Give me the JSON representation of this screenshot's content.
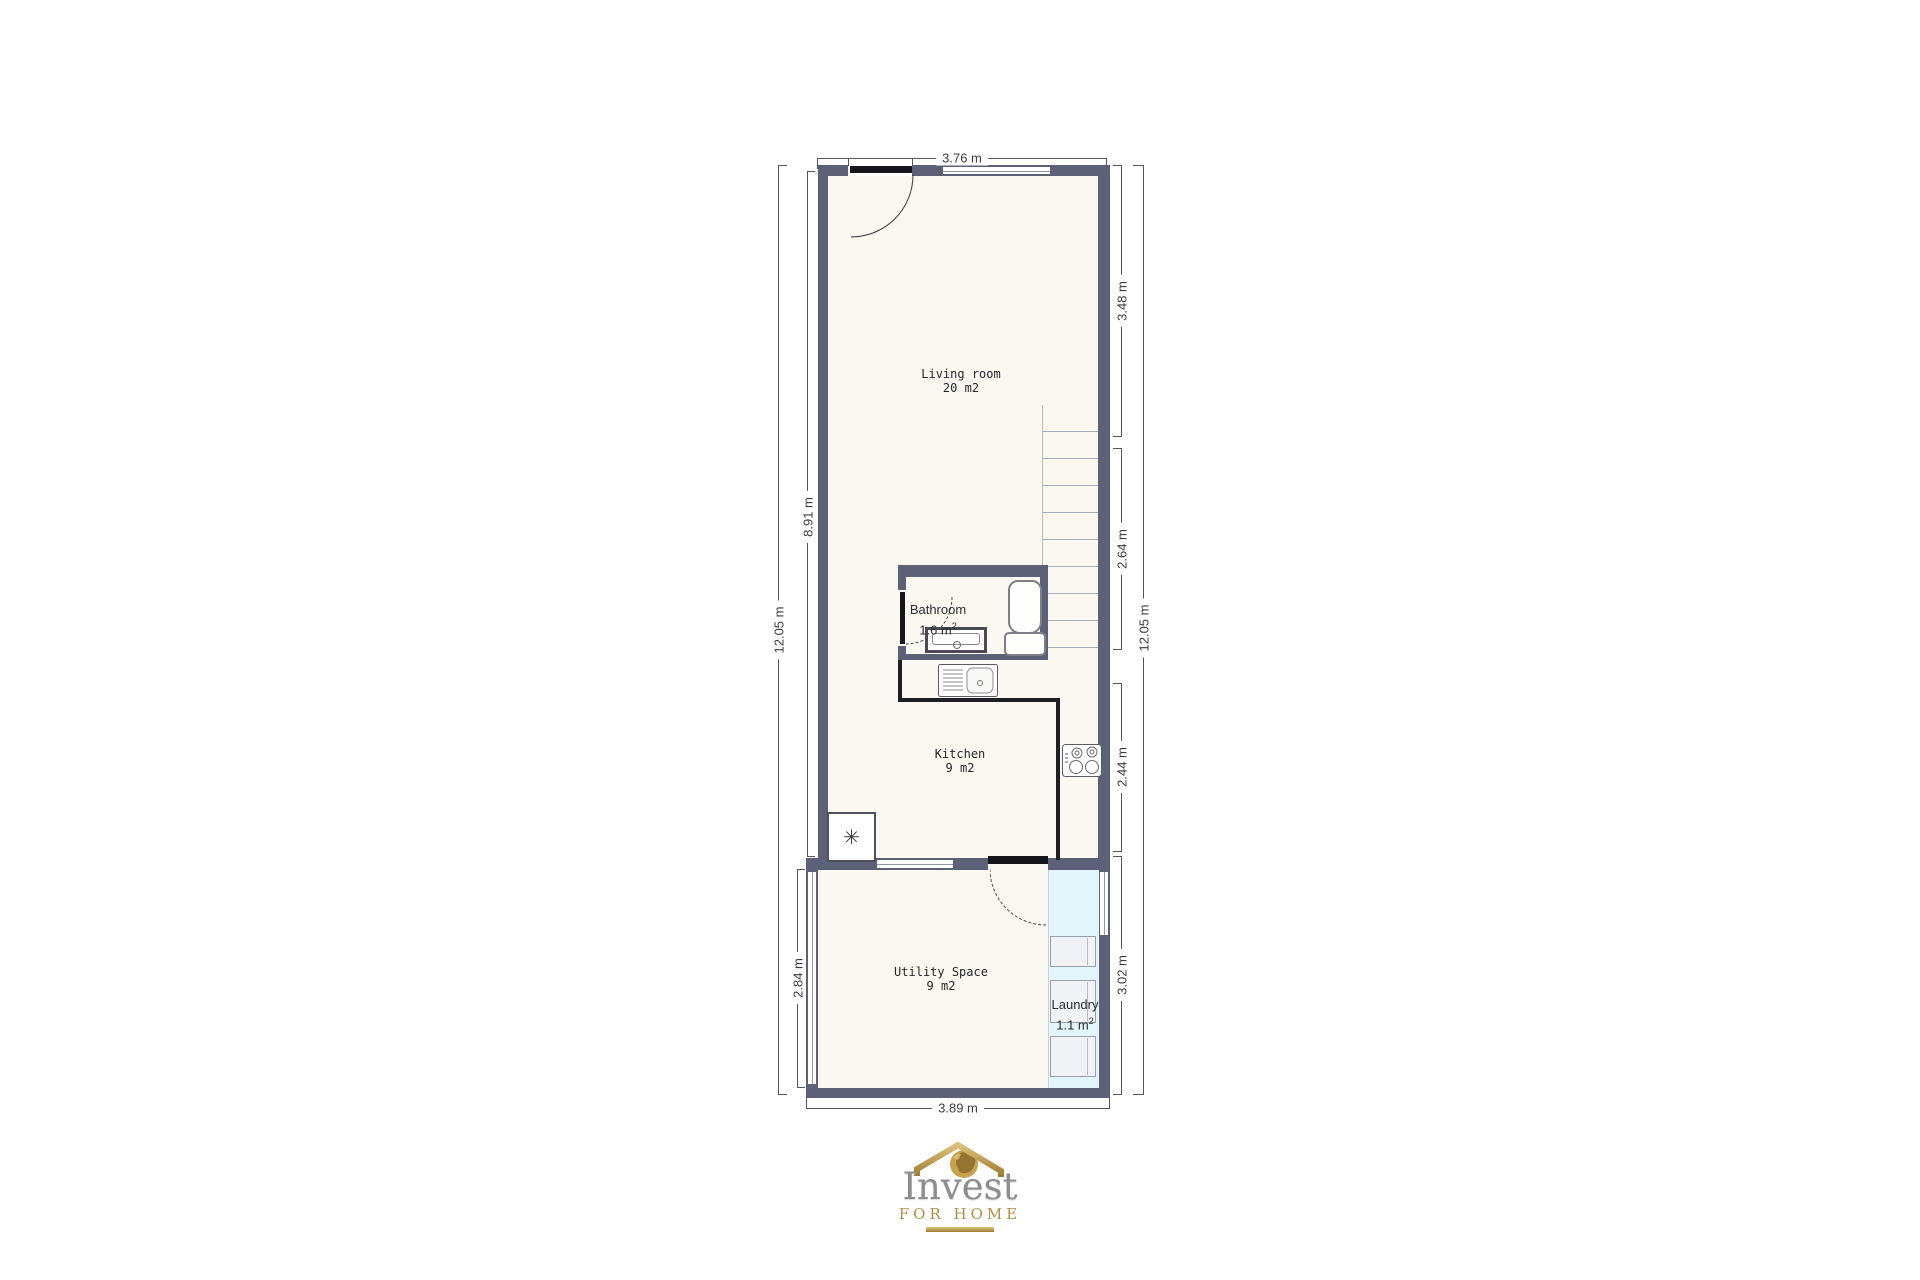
{
  "plan": {
    "rooms": {
      "living": {
        "name": "Living room",
        "area": "20 m2"
      },
      "bathroom": {
        "name": "Bathroom",
        "area": "1.6 m",
        "area_sup": "2"
      },
      "kitchen": {
        "name": "Kitchen",
        "area": "9 m2"
      },
      "utility": {
        "name": "Utility Space",
        "area": "9 m2"
      },
      "laundry": {
        "name": "Laundry",
        "area": "1.1 m",
        "area_sup": "2"
      }
    },
    "dimensions": {
      "top_width": "3.76 m",
      "bottom_width": "3.89 m",
      "left_total": "12.05 m",
      "left_upper": "8.91 m",
      "left_lower": "2.84 m",
      "right_total": "12.05 m",
      "right_living": "3.48 m",
      "right_stairs": "2.64 m",
      "right_kitchen": "2.44 m",
      "right_utility": "3.02 m"
    },
    "symbols": {
      "hvac_unit": "✳"
    },
    "colors": {
      "wall": "#5c6178",
      "floor": "#faf8f1",
      "laundry_zone": "#e2f5fa",
      "dimension_line": "#55565a",
      "logo_gold": "#b28f46",
      "logo_silver": "#8d8d90"
    }
  },
  "logo": {
    "title": "Invest",
    "subtitle": "FOR HOME"
  }
}
